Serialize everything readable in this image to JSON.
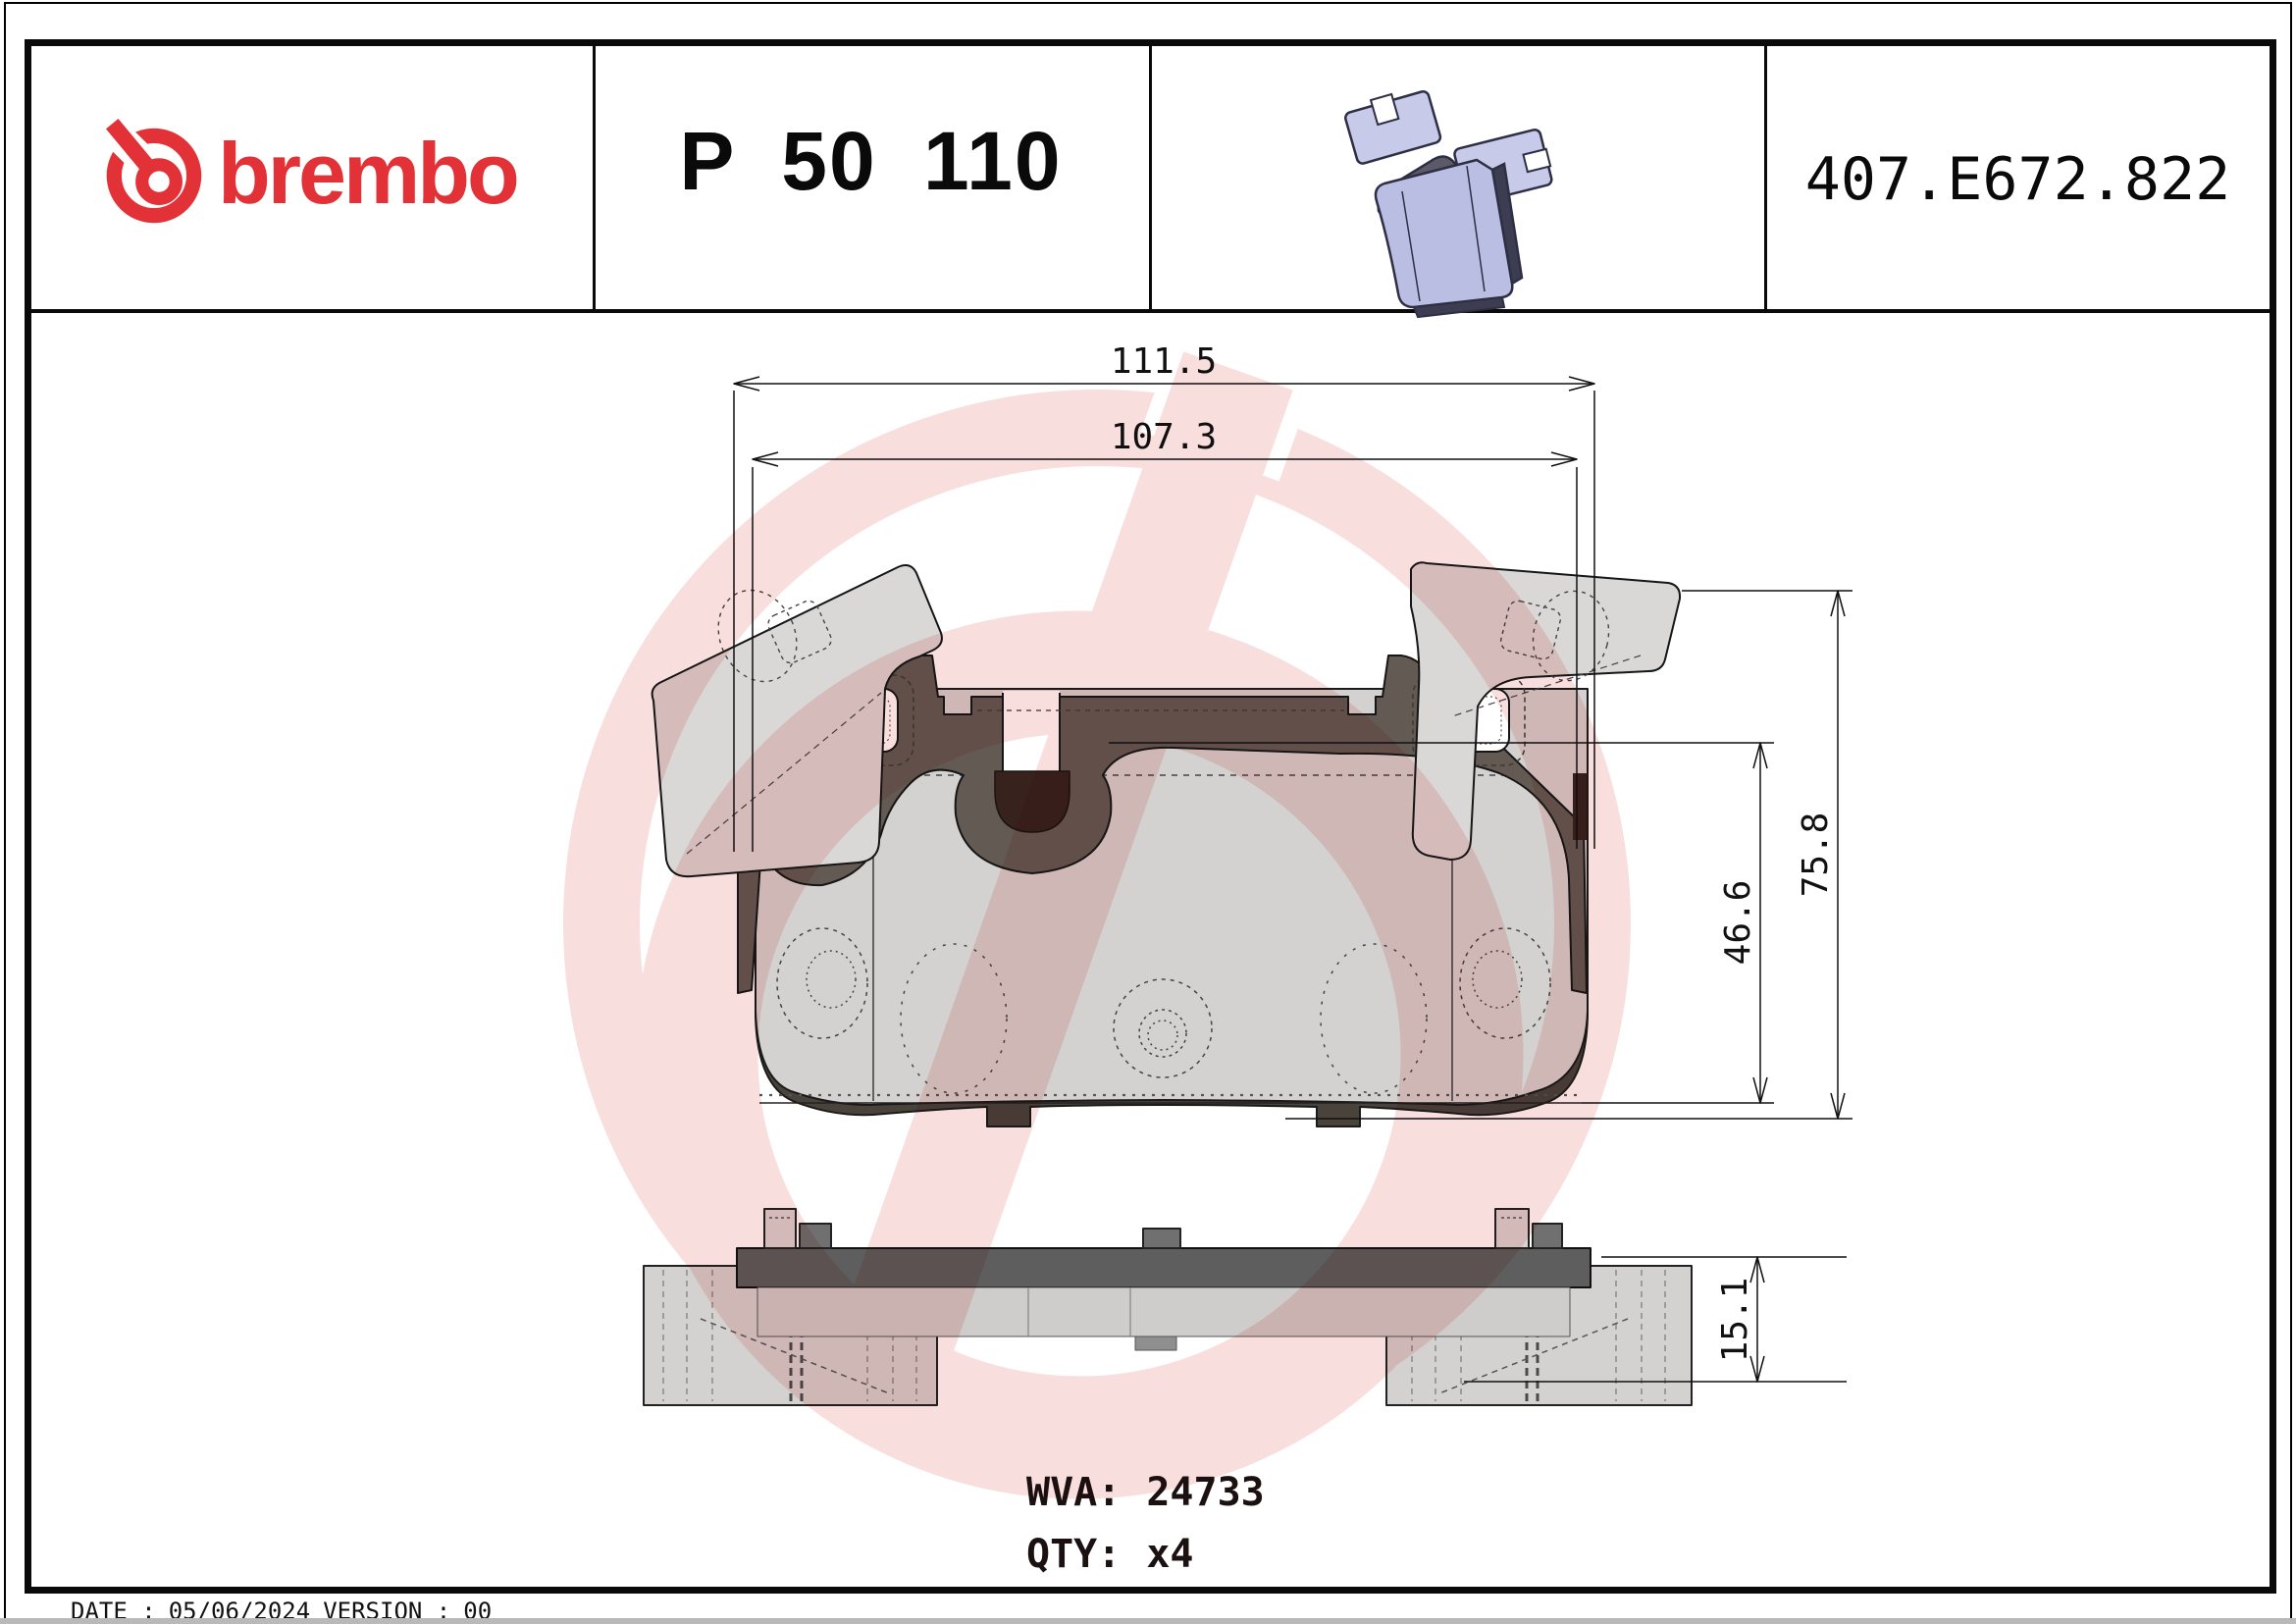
{
  "header": {
    "brand": "brembo",
    "part_number": "P 50 110",
    "catalog_code": "407.E672.822"
  },
  "dimensions": {
    "width_total": "111.5",
    "width_inner": "107.3",
    "height_total": "75.8",
    "height_inner": "46.6",
    "thickness": "15.1"
  },
  "info": {
    "wva_label": "WVA:",
    "wva_value": "24733",
    "qty_label": "QTY:",
    "qty_value": "x4"
  },
  "footer": {
    "date_label": "DATE :",
    "date_value": "05/06/2024",
    "version_label": "VERSION :",
    "version_value": "00"
  },
  "colors": {
    "brand_red": "#e23237",
    "watermark_pink": "#f9dede",
    "backplate_gray": "#645a54",
    "pad_light_gray": "#d4d2d0",
    "notch_dark_brown": "#38221e",
    "bottom_bar_gray": "#5e5e5e",
    "pad3d_lavender": "#babee2",
    "pad3d_dark": "#3d3d52"
  }
}
